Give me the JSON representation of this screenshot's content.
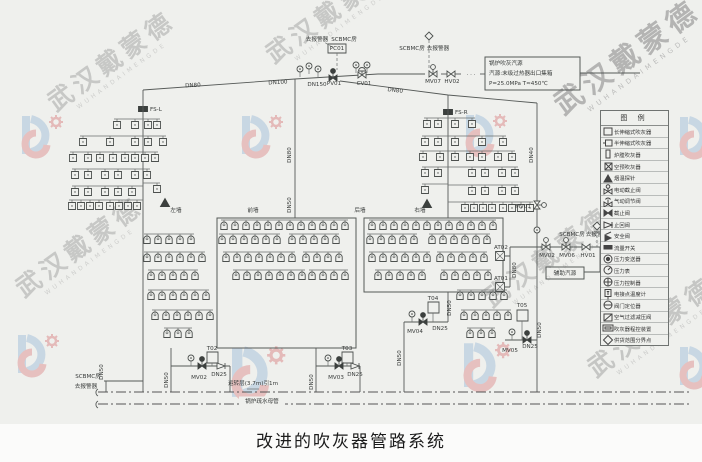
{
  "title": "改进的吹灰器管路系统",
  "watermark": {
    "cn": "武汉戴蒙德",
    "en": "WUHANDAIMENGDE"
  },
  "source_box": {
    "l1": "锅炉吹灰汽源",
    "l2": "汽源:末级过热器出口集箱",
    "l3": "P=25.0MPa T≈450℃"
  },
  "legend": {
    "header": "图 例",
    "items": [
      {
        "icon": "sq-l",
        "label": "长伸缩式吹灰器"
      },
      {
        "icon": "sq-m",
        "label": "半伸缩式吹灰器"
      },
      {
        "icon": "rect-v",
        "label": "炉膛吹灰器"
      },
      {
        "icon": "sq-x",
        "label": "空预吹灰器"
      },
      {
        "icon": "tri",
        "label": "烟温探针"
      },
      {
        "icon": "mov",
        "label": "电动截止阀"
      },
      {
        "icon": "pnv",
        "label": "气动调节阀"
      },
      {
        "icon": "gv",
        "label": "截止阀"
      },
      {
        "icon": "cv",
        "label": "止回阀"
      },
      {
        "icon": "sv",
        "label": "安全阀"
      },
      {
        "icon": "fsw",
        "label": "流量开关"
      },
      {
        "icon": "pt",
        "label": "压力变送器"
      },
      {
        "icon": "pg",
        "label": "压力表"
      },
      {
        "icon": "pc",
        "label": "压力控制器"
      },
      {
        "icon": "tt",
        "label": "电接点温度计"
      },
      {
        "icon": "vp",
        "label": "阀门定位器"
      },
      {
        "icon": "prv",
        "label": "空气过滤减压阀"
      },
      {
        "icon": "ctrl",
        "label": "吹灰器程控装置"
      },
      {
        "icon": "dia",
        "label": "供货范围分界点"
      }
    ]
  },
  "diagram": {
    "labels": [
      {
        "n": "dn80-left-label",
        "x": 193,
        "y": 87,
        "t": "DN80",
        "r": -3
      },
      {
        "n": "dn100-label",
        "x": 278,
        "y": 84,
        "t": "DN100",
        "r": -3
      },
      {
        "n": "dn150-label",
        "x": 317,
        "y": 86,
        "t": "DN150"
      },
      {
        "n": "dn80-slope-label",
        "x": 395,
        "y": 92,
        "t": "DN80",
        "r": 6
      },
      {
        "n": "fs-l-label",
        "x": 150,
        "y": 111,
        "t": "FS-L",
        "a": "start"
      },
      {
        "n": "fs-r-label",
        "x": 455,
        "y": 114,
        "t": "FS-R",
        "a": "start"
      },
      {
        "n": "pv01-label",
        "x": 334,
        "y": 85,
        "t": "PV01"
      },
      {
        "n": "cv01-label",
        "x": 364,
        "y": 85,
        "t": "CV01"
      },
      {
        "n": "pc01-label",
        "x": 337,
        "y": 50,
        "t": "PC01"
      },
      {
        "n": "alarm-top-label",
        "x": 317,
        "y": 41,
        "t": "去报警器"
      },
      {
        "n": "scbmc-top-label",
        "x": 344,
        "y": 41,
        "t": "SCBMC房"
      },
      {
        "n": "scbmc-mid-label",
        "x": 412,
        "y": 50,
        "t": "SCBMC房"
      },
      {
        "n": "alarm-mid-label",
        "x": 438,
        "y": 50,
        "t": "去报警器"
      },
      {
        "n": "mv07-label",
        "x": 433,
        "y": 83,
        "t": "MV07"
      },
      {
        "n": "hv02-label",
        "x": 452,
        "y": 83,
        "t": "HV02"
      },
      {
        "n": "line-break-dots",
        "x": 471,
        "y": 76,
        "t": "· · ·"
      },
      {
        "n": "src-line1",
        "x": 489,
        "y": 65,
        "t": "锅炉吹灰汽源",
        "a": "start"
      },
      {
        "n": "src-line2",
        "x": 489,
        "y": 75,
        "t": "汽源:末级过热器出口集箱",
        "a": "start"
      },
      {
        "n": "src-line3",
        "x": 489,
        "y": 85,
        "t": "P=25.0MPa T≈450℃",
        "a": "start"
      },
      {
        "n": "dn40-label",
        "x": 533,
        "y": 155,
        "t": "DN40",
        "r": -90
      },
      {
        "n": "mv01-label",
        "x": 531,
        "y": 208,
        "t": "MV01",
        "a": "end"
      },
      {
        "n": "dn80-center-label",
        "x": 291,
        "y": 155,
        "t": "DN80",
        "r": -90
      },
      {
        "n": "dn50-center-label",
        "x": 291,
        "y": 205,
        "t": "DN50",
        "r": -90
      },
      {
        "n": "wall-left-label",
        "x": 176,
        "y": 212,
        "t": "左墙"
      },
      {
        "n": "wall-front-label",
        "x": 253,
        "y": 212,
        "t": "前墙"
      },
      {
        "n": "wall-rear-label",
        "x": 360,
        "y": 212,
        "t": "后墙"
      },
      {
        "n": "wall-right-label",
        "x": 420,
        "y": 212,
        "t": "右墙"
      },
      {
        "n": "mv02-right-label",
        "x": 547,
        "y": 257,
        "t": "MV02"
      },
      {
        "n": "mv06-right-label",
        "x": 567,
        "y": 257,
        "t": "MV06"
      },
      {
        "n": "hv01-right-label",
        "x": 588,
        "y": 257,
        "t": "HV01"
      },
      {
        "n": "at02-label",
        "x": 494,
        "y": 249,
        "t": "AT02",
        "a": "start"
      },
      {
        "n": "at01-label",
        "x": 494,
        "y": 280,
        "t": "AT01",
        "a": "start"
      },
      {
        "n": "dn80-right-label",
        "x": 516,
        "y": 270,
        "t": "DN80",
        "r": -90
      },
      {
        "n": "scbmc-right-label",
        "x": 572,
        "y": 236,
        "t": "SCBMC房"
      },
      {
        "n": "alarm-right-label",
        "x": 597,
        "y": 236,
        "t": "去报警器"
      },
      {
        "n": "aux-source-box-label",
        "x": 565,
        "y": 275,
        "t": "辅助汽源"
      },
      {
        "n": "t02-label",
        "x": 212,
        "y": 350,
        "t": "T02"
      },
      {
        "n": "mv02-drain-label",
        "x": 199,
        "y": 379,
        "t": "MV02"
      },
      {
        "n": "dn25-t02-label",
        "x": 219,
        "y": 376,
        "t": "DN25"
      },
      {
        "n": "dn50-t02-label",
        "x": 168,
        "y": 380,
        "t": "DN50",
        "r": -90
      },
      {
        "n": "dn50-left-label",
        "x": 103,
        "y": 372,
        "t": "DN50",
        "r": -90
      },
      {
        "n": "t03-label",
        "x": 347,
        "y": 350,
        "t": "T03"
      },
      {
        "n": "mv03-drain-label",
        "x": 336,
        "y": 379,
        "t": "MV03"
      },
      {
        "n": "dn25-t03-label",
        "x": 355,
        "y": 376,
        "t": "DN25"
      },
      {
        "n": "dn50-t03-label",
        "x": 313,
        "y": 382,
        "t": "DN50",
        "r": -90
      },
      {
        "n": "t04-label",
        "x": 433,
        "y": 300,
        "t": "T04"
      },
      {
        "n": "mv04-label",
        "x": 415,
        "y": 333,
        "t": "MV04"
      },
      {
        "n": "dn25-t04-label",
        "x": 440,
        "y": 330,
        "t": "DN25"
      },
      {
        "n": "dn50-t04-label",
        "x": 451,
        "y": 308,
        "t": "DN50",
        "r": -90
      },
      {
        "n": "dn50-t04b-label",
        "x": 401,
        "y": 358,
        "t": "DN50",
        "r": -90
      },
      {
        "n": "t05-label",
        "x": 522,
        "y": 307,
        "t": "T05"
      },
      {
        "n": "mv05-label",
        "x": 510,
        "y": 352,
        "t": "MV05"
      },
      {
        "n": "dn25-t05-label",
        "x": 530,
        "y": 348,
        "t": "DN25"
      },
      {
        "n": "dn50-t05-label",
        "x": 541,
        "y": 330,
        "t": "DN50",
        "r": -90
      },
      {
        "n": "level-note-label",
        "x": 253,
        "y": 385,
        "t": "运转层(3.7m)引1m"
      },
      {
        "n": "drain-header-label",
        "x": 262,
        "y": 403,
        "t": "锅炉疏水母管",
        "bg": true
      },
      {
        "n": "scbmc-bottomleft-label",
        "x": 88,
        "y": 378,
        "t": "SCBMC房"
      },
      {
        "n": "alarm-bottomleft-label",
        "x": 86,
        "y": 388,
        "t": "去报警器"
      }
    ],
    "blower_rows": [
      {
        "y": 226,
        "g": [
          [
            224,
            12,
            11
          ],
          [
            372,
            12,
            11
          ]
        ]
      },
      {
        "y": 240,
        "g": [
          [
            147,
            5,
            11
          ],
          [
            222,
            6,
            11
          ],
          [
            292,
            5,
            11
          ],
          [
            370,
            5,
            11
          ],
          [
            432,
            6,
            11
          ]
        ]
      },
      {
        "y": 258,
        "g": [
          [
            147,
            6,
            11
          ],
          [
            226,
            7,
            11
          ],
          [
            306,
            4,
            11
          ],
          [
            372,
            6,
            11
          ],
          [
            440,
            5,
            11
          ]
        ]
      },
      {
        "y": 276,
        "g": [
          [
            151,
            5,
            11
          ],
          [
            236,
            7,
            11
          ],
          [
            312,
            4,
            11
          ],
          [
            378,
            5,
            11
          ],
          [
            444,
            5,
            11
          ]
        ]
      },
      {
        "y": 296,
        "g": [
          [
            151,
            6,
            11
          ],
          [
            460,
            5,
            11
          ]
        ]
      },
      {
        "y": 316,
        "g": [
          [
            155,
            6,
            11
          ],
          [
            464,
            5,
            11
          ]
        ]
      },
      {
        "y": 334,
        "g": [
          [
            167,
            3,
            11
          ],
          [
            470,
            3,
            11
          ]
        ]
      }
    ],
    "trees": [
      {
        "trunk": 143,
        "top": 90,
        "bot": 392,
        "rows": [
          {
            "y": 125,
            "xs": [
              117,
              135,
              148,
              157
            ]
          },
          {
            "y": 142,
            "xs": [
              83,
              110,
              135,
              148,
              163
            ]
          },
          {
            "y": 158,
            "xs": [
              73,
              88,
              100,
              113,
              125,
              135,
              145,
              155
            ]
          },
          {
            "y": 175,
            "xs": [
              75,
              88,
              105,
              118,
              135,
              147
            ]
          },
          {
            "y": 192,
            "xs": [
              75,
              88,
              105,
              118,
              132
            ]
          },
          {
            "y": 206,
            "xs": [
              72,
              81,
              90,
              99,
              110,
              119,
              128,
              137
            ]
          },
          {
            "y": 189,
            "xs": [
              157
            ]
          }
        ],
        "tri": [
          165,
          203
        ]
      },
      {
        "trunk": 448,
        "top": 95,
        "bot": 218,
        "rows": [
          {
            "y": 124,
            "xs": [
              427,
              438,
              455,
              472
            ]
          },
          {
            "y": 142,
            "xs": [
              425,
              438,
              455,
              482,
              503
            ]
          },
          {
            "y": 157,
            "xs": [
              423,
              440,
              455,
              470,
              482,
              498,
              512
            ]
          },
          {
            "y": 173,
            "xs": [
              425,
              438,
              472,
              485,
              502,
              515
            ]
          },
          {
            "y": 191,
            "xs": [
              472,
              485,
              502,
              515
            ]
          },
          {
            "y": 208,
            "xs": [
              465,
              474,
              483,
              492,
              503,
              512,
              521,
              530
            ]
          },
          {
            "y": 190,
            "xs": [
              425
            ]
          }
        ],
        "tri": [
          427,
          204
        ]
      }
    ]
  }
}
